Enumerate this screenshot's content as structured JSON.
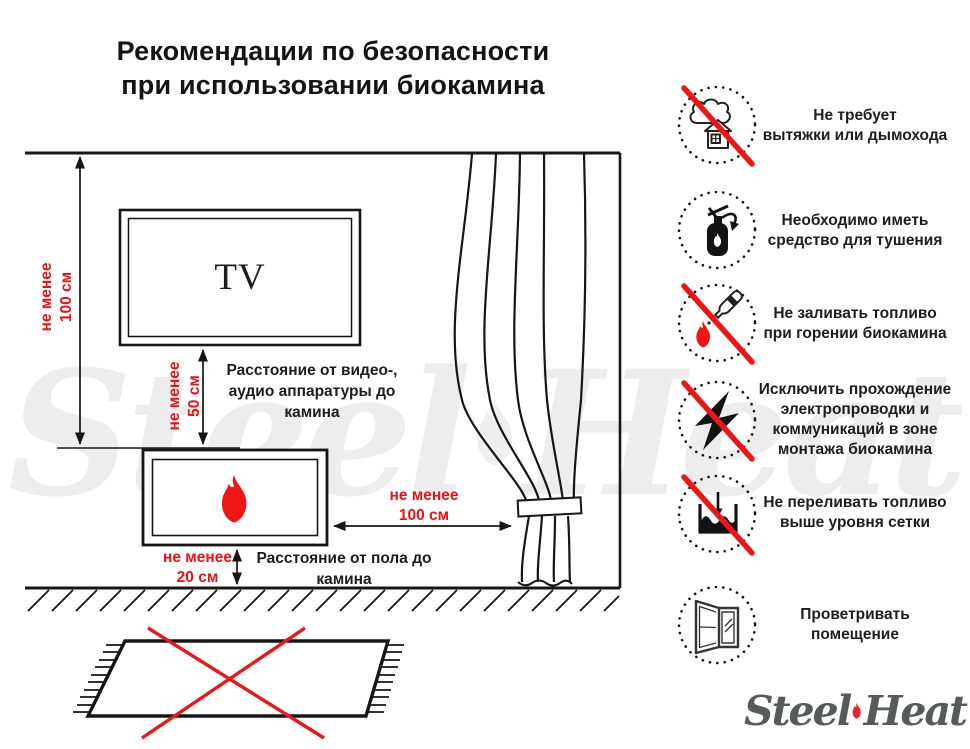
{
  "title": {
    "line1": "Рекомендации по безопасности",
    "line2": "при использовании биокамина"
  },
  "diagram": {
    "tv_label": "TV",
    "wall_distance": {
      "line1": "не менее",
      "line2": "100 см"
    },
    "tv_distance": {
      "line1": "не менее",
      "line2": "50 см"
    },
    "tv_note": {
      "line1": "Расстояние от видео-,",
      "line2": "аудио аппаратуры до",
      "line3": "камина"
    },
    "curtain_distance": {
      "line1": "не менее",
      "line2": "100 см"
    },
    "floor_distance": {
      "line1": "не менее",
      "line2": "20 см"
    },
    "floor_note": {
      "line1": "Расстояние от пола до",
      "line2": "камина"
    }
  },
  "rules": [
    {
      "icon": "no-chimney-icon",
      "lines": [
        "Не требует",
        "вытяжки или дымохода"
      ]
    },
    {
      "icon": "fire-extinguisher-icon",
      "lines": [
        "Необходимо иметь",
        "средство для тушения"
      ]
    },
    {
      "icon": "no-refueling-while-burning-icon",
      "lines": [
        "Не заливать топливо",
        "при горении биокамина"
      ]
    },
    {
      "icon": "no-electrical-wiring-icon",
      "lines": [
        "Исключить прохождение",
        "электропроводки и",
        "коммуникаций в зоне",
        "монтажа биокамина"
      ]
    },
    {
      "icon": "no-overfilling-icon",
      "lines": [
        "Не переливать топливо",
        "выше уровня сетки"
      ]
    },
    {
      "icon": "ventilate-room-icon",
      "lines": [
        "Проветривать",
        "помещение"
      ]
    }
  ],
  "logo": {
    "steel": "Steel",
    "heat": "Heat"
  },
  "watermark": {
    "steel": "Steel",
    "heat": "Heat"
  },
  "colors": {
    "accent_red": "#ee1111",
    "line_black": "#161616",
    "logo_gray": "#58595b"
  }
}
